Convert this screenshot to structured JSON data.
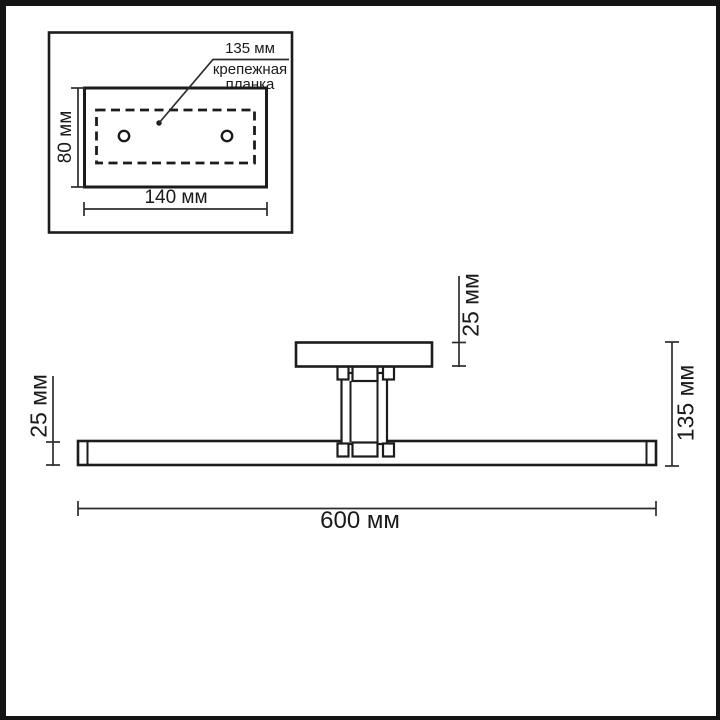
{
  "inset": {
    "callout_value": "135 мм",
    "callout_label_line1": "крепежная",
    "callout_label_line2": "планка",
    "height_dim": "80 мм",
    "width_dim": "140 мм"
  },
  "main": {
    "plate_thickness_dim": "25 мм",
    "bar_thickness_dim": "25 мм",
    "overall_height_dim": "135 мм",
    "overall_length_dim": "600 мм"
  },
  "colors": {
    "line": "#1c1c1c",
    "dimension_line": "#2d2d2d",
    "background": "#ffffff",
    "frame": "#141414"
  }
}
